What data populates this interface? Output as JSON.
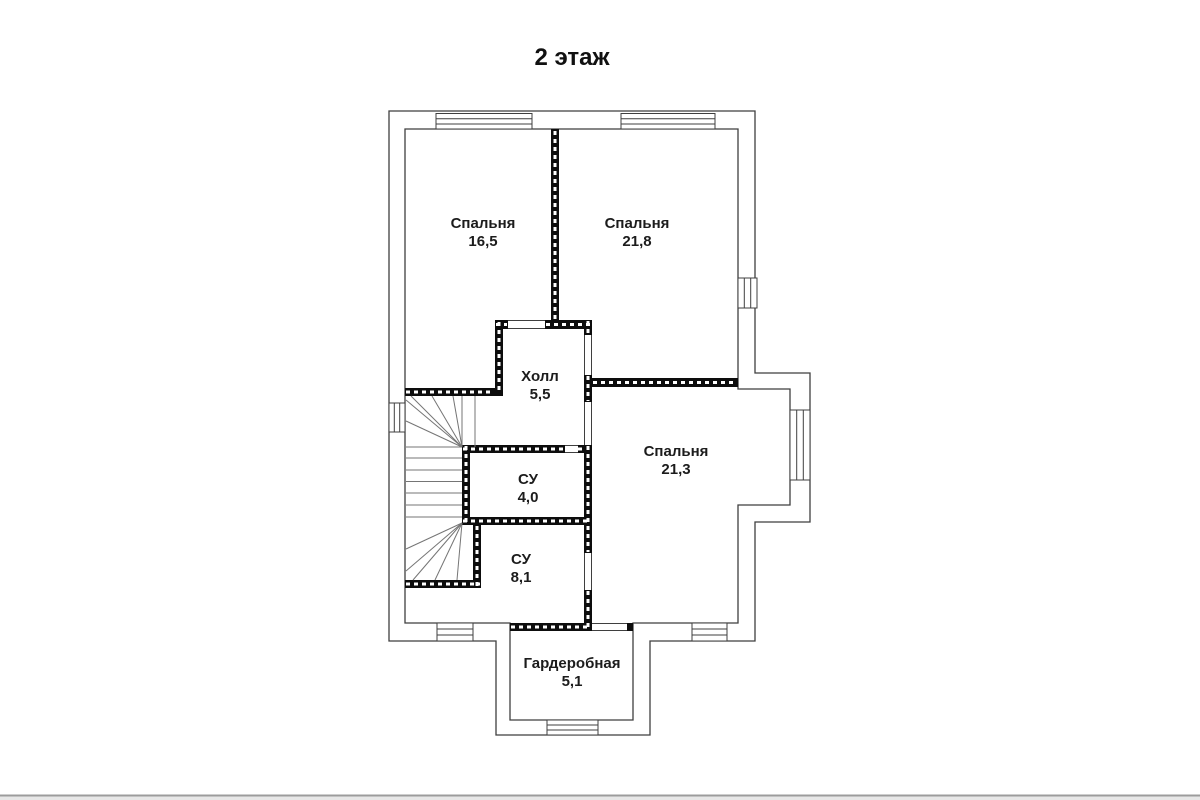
{
  "page": {
    "title": "2 этаж"
  },
  "rooms": [
    {
      "id": "bedroom-1",
      "name": "Спальня",
      "area": "16,5"
    },
    {
      "id": "bedroom-2",
      "name": "Спальня",
      "area": "21,8"
    },
    {
      "id": "hall",
      "name": "Холл",
      "area": "5,5"
    },
    {
      "id": "bedroom-3",
      "name": "Спальня",
      "area": "21,3"
    },
    {
      "id": "bathroom-1",
      "name": "СУ",
      "area": "4,0"
    },
    {
      "id": "bathroom-2",
      "name": "СУ",
      "area": "8,1"
    },
    {
      "id": "wardrobe",
      "name": "Гардеробная",
      "area": "5,1"
    }
  ],
  "colors": {
    "background": "#ffffff",
    "wall_line": "#3f3f3f",
    "partition_fill": "#0d0d0d",
    "partition_dash": "#ffffff",
    "stair_line": "#757575",
    "text": "#1c1c1c",
    "footer_line": "#9c9c9c",
    "footer_strip": "#e7e7e7"
  }
}
